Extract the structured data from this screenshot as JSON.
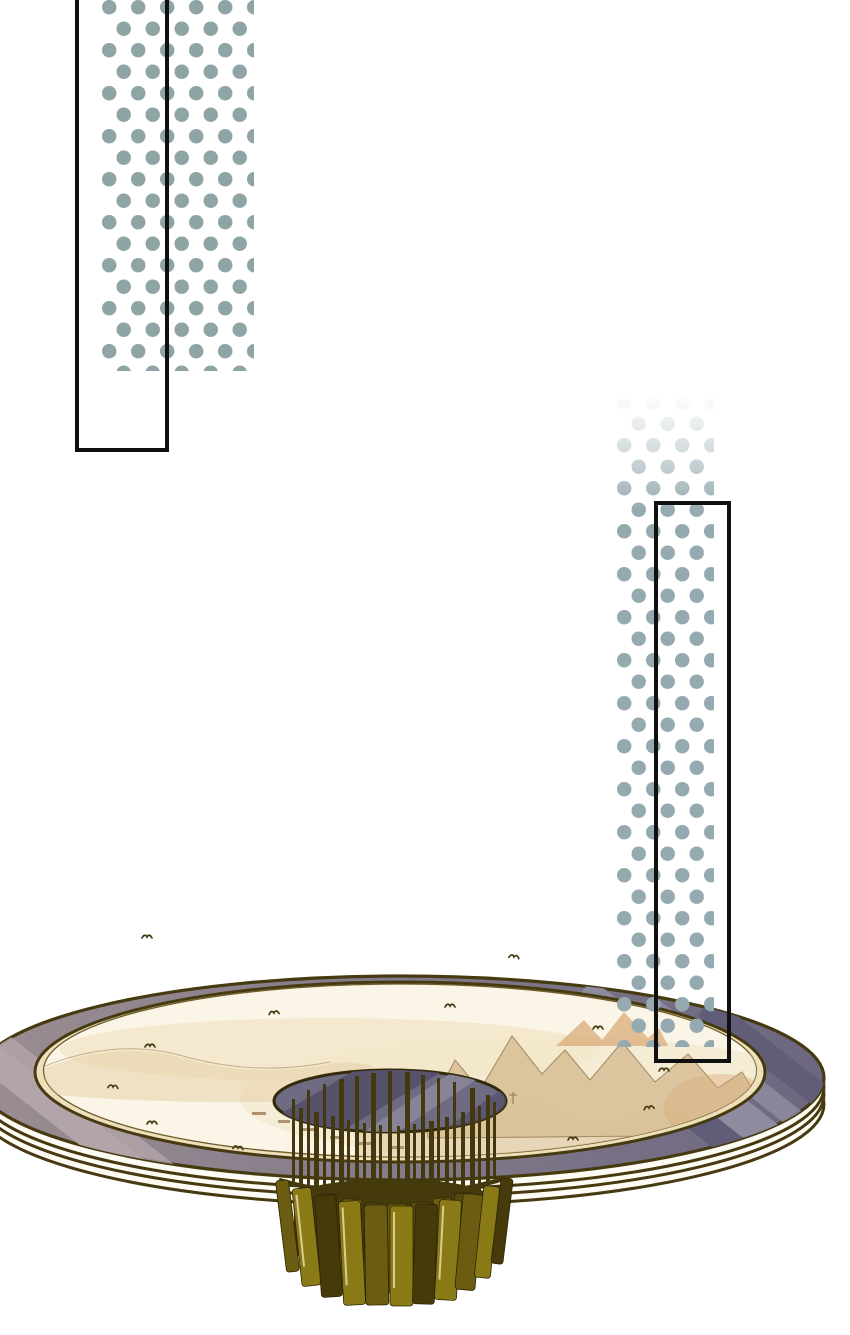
{
  "scene": {
    "kind": "webtoon-art-panel",
    "description": "Decorative comic page: two teal halftone dot strips overlaid with black rectangular panel frames; below, a large elliptical platform painted with a sepia shan-shui landscape, ringed by a slate-purple band and white stacked rim, with a gold slatted chandelier hanging from a dark central opening.",
    "background": "#ffffff",
    "text_content": []
  },
  "css_vars": {
    "--bg": "#ffffff",
    "--frame": "#101010",
    "--dot-left": "#8fa4a4",
    "--dot-right": "#95aab0",
    "--outline": "#463a10",
    "--rim": "#fdfcf4",
    "--gold": "#efe0bc",
    "--cream": "#faf5e6",
    "--cream-line": "#6e5d2a",
    "--band-streak-l": "#b2a5a9",
    "--band-streak-r": "#8f8b9e",
    "--band-streak-d": "#615d78",
    "--paint-haze": "#f2e6c9",
    "--paint-light": "#e6d2a8",
    "--paint-mid": "#d8bf94",
    "--paint-line": "#9c7f55",
    "--paint-accent": "#d8ab78",
    "--hole": "#6f6b83",
    "--hole-band": "#56526b",
    "--hole-streak": "#8b8799",
    "--hole-line": "#342a0a",
    "--rod": "#44380e",
    "--cyl": "#453a0c",
    "--panel-gold": "#8a7a16",
    "--panel-olive": "#6b5c12",
    "--panel-dark": "#463a0b",
    "--panel-deep": "#57490e",
    "--panel-hl": "#d9cc90",
    "--bird": "#463a14"
  },
  "palette": {
    "band_left": "#9a8d92",
    "band_mid": "#837a8a",
    "band_right": "#6c6780"
  },
  "halftone_strips": {
    "left": {
      "dot_color": "#8fa4a4",
      "fade": "clipped at bottom",
      "position": "top-left"
    },
    "right": {
      "dot_color": "#95aab0",
      "fade": "fades in from top",
      "position": "middle-right, overlaps platform"
    }
  },
  "frames": {
    "top_left": {
      "border_color": "#101010",
      "border_px": 4,
      "open_top": true
    },
    "right": {
      "border_color": "#101010",
      "border_px": 4
    }
  },
  "platform": {
    "outline_color": "#463a10",
    "outer_band": [
      "#9a8d92",
      "#6c6780"
    ],
    "side_rim_color": "#fdfcf4",
    "inner_rim_color": "#efe0bc",
    "surface_color": "#faf5e6",
    "painting": "sepia classical landscape with mountains, trees and village marks",
    "stacked_rim_lines": 3
  },
  "chandelier": {
    "hole_color": "#6f6b83",
    "rod_color": "#44380e",
    "rod_count": 26,
    "panel_colors": [
      "#8a7a16",
      "#6b5c12",
      "#463a0b",
      "#57490e"
    ],
    "panel_highlight": "#d9cc90",
    "outer_panel_count": 11,
    "inner_panel_count": 7
  },
  "birds": {
    "color": "#463a14",
    "count": 12
  }
}
